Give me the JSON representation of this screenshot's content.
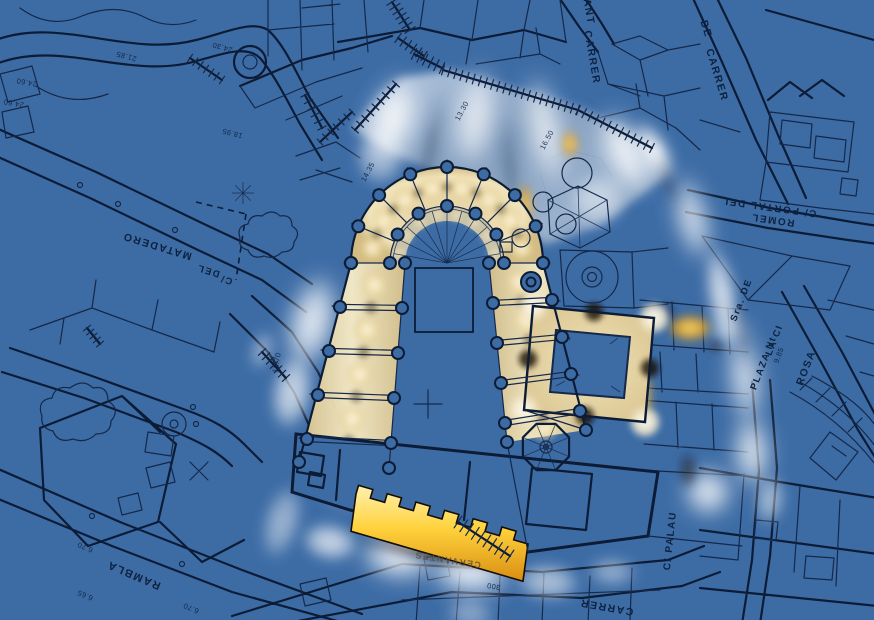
{
  "document": {
    "type": "architectural site plan with lighting study",
    "style": "blueprint city cadastral map, photometric glow overlay",
    "subject": "Cathedral plan with illuminated bays, cloister courtyard and surrounding streets"
  },
  "colors": {
    "map_background": "#3D6CA5",
    "line_dark": "#14284A",
    "line_heavy": "#0C1C36",
    "glow_white": "#FFFFFF",
    "glow_cream": "#F2E4BC",
    "glow_gold": "#FFD24A",
    "glow_amber": "#E8A41E",
    "shadow_warm": "#1C1406",
    "beam_shadow": "#2F4A6B",
    "label_ink": "#0D2240"
  },
  "plan_features": [
    "apse colonnade",
    "ambulatory",
    "nave",
    "side aisles",
    "west facade with crenellated portal",
    "cloister courtyard",
    "octagonal tower",
    "fountain circle",
    "hexagonal block",
    "roundabout",
    "stair ramps"
  ],
  "street_labels": [
    {
      "id": "sant",
      "text": "SANT",
      "x": 585,
      "y": 8,
      "rot": 80,
      "size": 10.5,
      "cls": "street"
    },
    {
      "id": "carrer-n",
      "text": "CARRER",
      "x": 589,
      "y": 58,
      "rot": 80,
      "size": 10.5,
      "cls": "street"
    },
    {
      "id": "de",
      "text": "DE",
      "x": 703,
      "y": 30,
      "rot": 73,
      "size": 10.5,
      "cls": "street"
    },
    {
      "id": "carrer-ne",
      "text": "CARRER",
      "x": 714,
      "y": 76,
      "rot": 73,
      "size": 10.5,
      "cls": "street"
    },
    {
      "id": "portal-del",
      "text": "C/ PORTAL DEL",
      "x": 769,
      "y": 204,
      "rot": 188,
      "size": 10,
      "cls": "street"
    },
    {
      "id": "romel",
      "text": "ROMEL",
      "x": 773,
      "y": 217,
      "rot": 188,
      "size": 10,
      "cls": "street"
    },
    {
      "id": "plaza-n",
      "text": "PLAZA Nt",
      "x": 766,
      "y": 364,
      "rot": -69,
      "size": 9.5,
      "cls": "street"
    },
    {
      "id": "la-ci",
      "text": "LA CI",
      "x": 777,
      "y": 341,
      "rot": -69,
      "size": 9.5,
      "cls": "street"
    },
    {
      "id": "sra-de",
      "text": "Sra. DE",
      "x": 744,
      "y": 301,
      "rot": -69,
      "size": 9.5,
      "cls": "street"
    },
    {
      "id": "rosa",
      "text": "ROSA",
      "x": 809,
      "y": 369,
      "rot": -69,
      "size": 10.5,
      "cls": "street"
    },
    {
      "id": "palau",
      "text": "C/ PALAU",
      "x": 673,
      "y": 541,
      "rot": -84,
      "size": 10,
      "cls": "street"
    },
    {
      "id": "carrer-s",
      "text": "CARRER",
      "x": 607,
      "y": 604,
      "rot": 190,
      "size": 10.5,
      "cls": "street"
    },
    {
      "id": "rambla",
      "text": "RAMBLA",
      "x": 135,
      "y": 572,
      "rot": 203,
      "size": 11,
      "cls": "street"
    },
    {
      "id": "c-slash",
      "text": "C/",
      "x": 227,
      "y": 277,
      "rot": 197,
      "size": 9.5,
      "cls": "street"
    },
    {
      "id": "del",
      "text": "DEL",
      "x": 209,
      "y": 268,
      "rot": 197,
      "size": 9.5,
      "cls": "street"
    },
    {
      "id": "matadero",
      "text": "MATADERO",
      "x": 158,
      "y": 243,
      "rot": 197,
      "size": 10.5,
      "cls": "street"
    },
    {
      "id": "cervantes",
      "text": "CERVANTES",
      "x": 448,
      "y": 557,
      "rot": 189,
      "size": 9,
      "cls": "street-faint"
    }
  ],
  "elevation_marks": [
    {
      "text": "24.60",
      "x": 27,
      "y": 80,
      "rot": 190
    },
    {
      "text": "24.60",
      "x": 14,
      "y": 101,
      "rot": 190
    },
    {
      "text": "21.85",
      "x": 127,
      "y": 54,
      "rot": 195
    },
    {
      "text": "24.30",
      "x": 223,
      "y": 45,
      "rot": 195
    },
    {
      "text": "18.95",
      "x": 233,
      "y": 131,
      "rot": 195
    },
    {
      "text": "13.30",
      "x": 464,
      "y": 112,
      "rot": -62
    },
    {
      "text": "16.50",
      "x": 549,
      "y": 141,
      "rot": -62
    },
    {
      "text": "14.35",
      "x": 370,
      "y": 173,
      "rot": -62
    },
    {
      "text": "11.70",
      "x": 279,
      "y": 363,
      "rot": -80
    },
    {
      "text": "9.85",
      "x": 781,
      "y": 356,
      "rot": -69
    },
    {
      "text": "6.70",
      "x": 86,
      "y": 545,
      "rot": 203
    },
    {
      "text": "6.65",
      "x": 86,
      "y": 593,
      "rot": 203
    },
    {
      "text": "6.70",
      "x": 192,
      "y": 606,
      "rot": 203
    },
    {
      "text": "300",
      "x": 494,
      "y": 584,
      "rot": 190
    }
  ]
}
